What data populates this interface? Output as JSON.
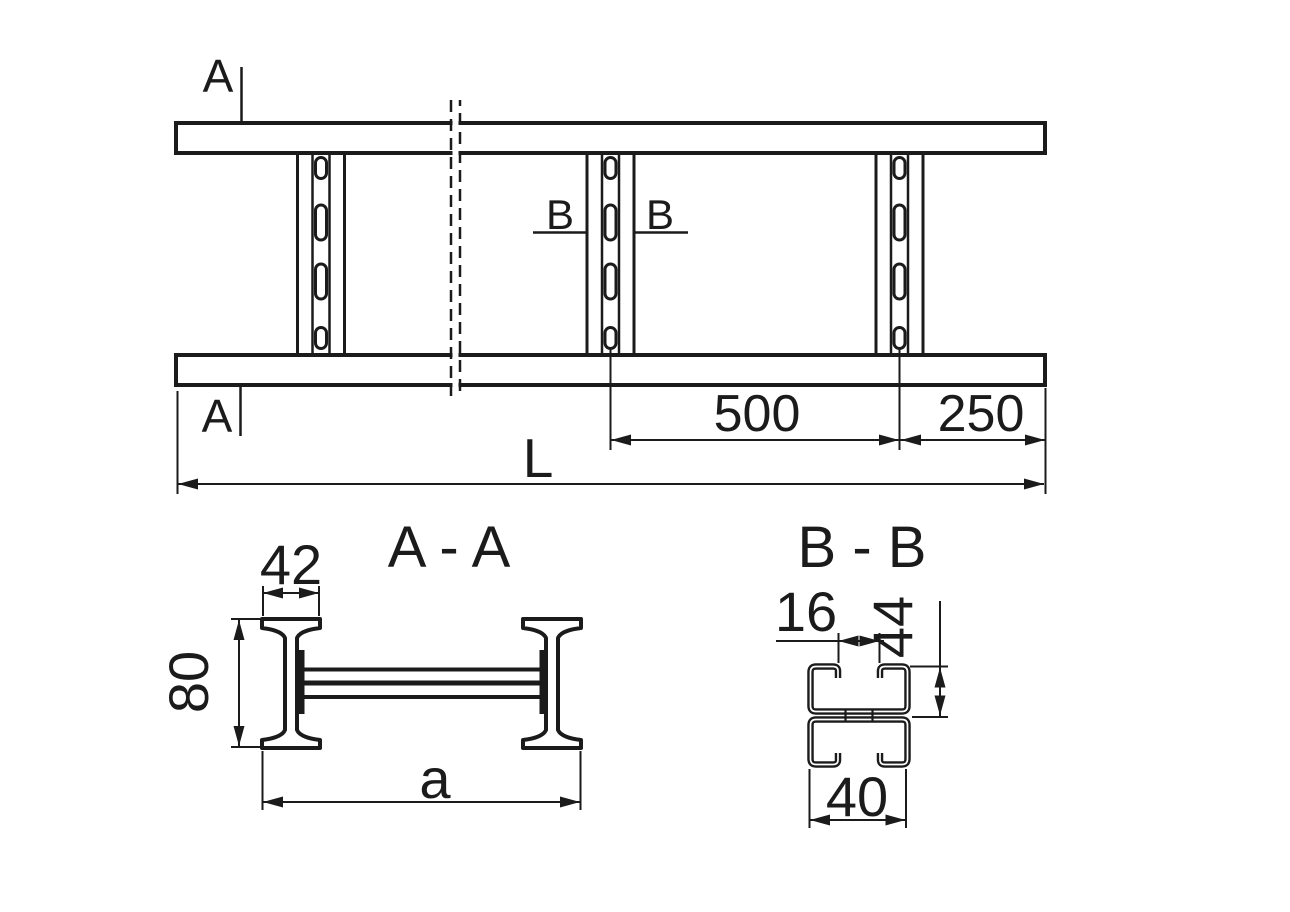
{
  "plan": {
    "section_a_label": "A",
    "section_b_label": "B",
    "dim_rung_to_rung": "500",
    "dim_end_offset": "250",
    "dim_total_length": "L"
  },
  "section_aa": {
    "title": "A - A",
    "dim_flange_width": "42",
    "dim_rail_height": "80",
    "dim_overall_width": "a"
  },
  "section_bb": {
    "title": "B - B",
    "dim_slot_width": "16",
    "dim_channel_height": "44",
    "dim_rung_width": "40"
  },
  "colors": {
    "line": "#1b1b1b",
    "background": "#ffffff"
  }
}
